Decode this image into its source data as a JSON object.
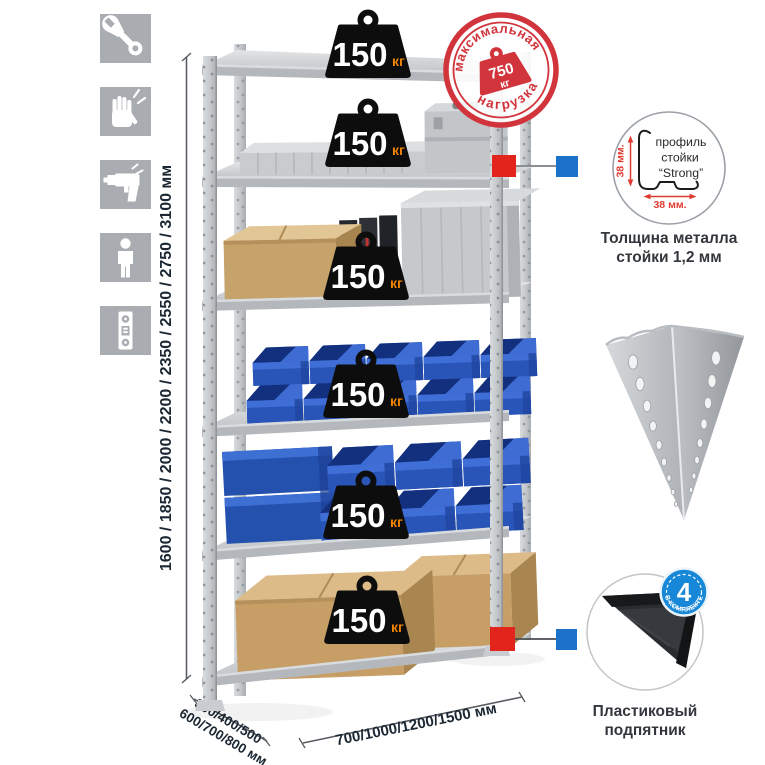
{
  "assembly_icons": {
    "items": [
      "wrench",
      "gloves",
      "drill",
      "person",
      "level"
    ]
  },
  "dimensions": {
    "height_label": "1600 / 1850 / 2000 / 2200 / 2350 / 2550 / 2750 / 3100 мм",
    "depth_label_line1": "300/400/500",
    "depth_label_line2": "600/700/800 мм",
    "width_label": "700/1000/1200/1500 мм"
  },
  "weight_badge": {
    "value": "150",
    "unit": "кг",
    "count": 6
  },
  "max_load_stamp": {
    "arc_top": "максимальная",
    "arc_bottom": "нагрузка",
    "value": "750",
    "unit": "кг"
  },
  "profile_detail": {
    "dim_vertical": "38 мм.",
    "dim_horizontal": "38 мм.",
    "label_line1": "профиль",
    "label_line2": "стойки",
    "label_line3": "“Strong”",
    "caption_line1": "Толщина металла",
    "caption_line2": "стойки 1,2 мм"
  },
  "foot_detail": {
    "badge_value": "4",
    "badge_arc_text": "В КОМПЛЕКТЕ",
    "caption_line1": "Пластиковый",
    "caption_line2": "подпятник"
  },
  "colors": {
    "stamp_red": "#d2343c",
    "marker_red": "#e3241d",
    "marker_blue": "#1b72c8",
    "foot_badge_blue": "#1787d8",
    "bin_blue": "#2d5ec2",
    "cardboard_tan": "#c9a36c",
    "metal_grey": "#c6cacd",
    "badge_unit_orange": "#f08300",
    "dimension_text": "#1b2733"
  }
}
